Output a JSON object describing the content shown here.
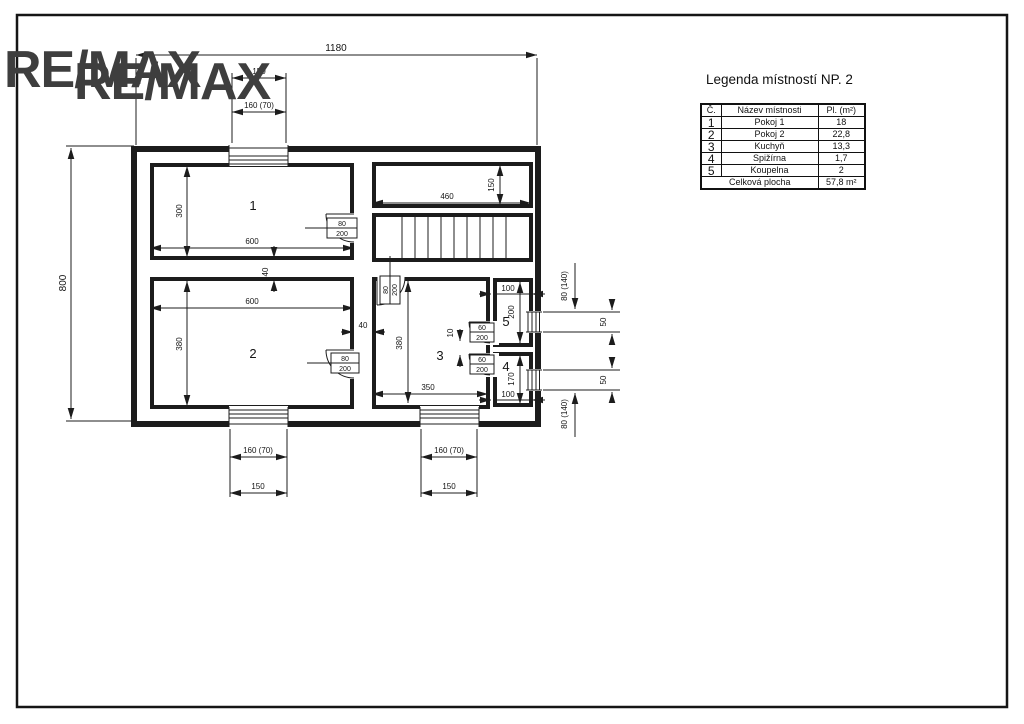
{
  "logo": {
    "text": "RE/MAX"
  },
  "legend": {
    "title": "Legenda místností NP. 2",
    "col_no": "Č.",
    "col_name": "Název místnosti",
    "col_area": "Pl. (m²)",
    "rows": [
      {
        "no": "1",
        "name": "Pokoj 1",
        "area": "18"
      },
      {
        "no": "2",
        "name": "Pokoj 2",
        "area": "22,8"
      },
      {
        "no": "3",
        "name": "Kuchyň",
        "area": "13,3"
      },
      {
        "no": "4",
        "name": "Spižírna",
        "area": "1,7"
      },
      {
        "no": "5",
        "name": "Koupelna",
        "area": "2"
      }
    ],
    "total_label": "Celková plocha",
    "total_value": "57,8 m²"
  },
  "plan": {
    "rooms": {
      "r1": "1",
      "r2": "2",
      "r3": "3",
      "r4": "4",
      "r5": "5"
    },
    "dims": {
      "overall_w": "1180",
      "overall_h": "800",
      "win_w": "160 (70)",
      "win_w_clear": "150",
      "r1_h": "300",
      "r1_w": "600",
      "wall": "40",
      "r2_w": "600",
      "r2_h": "380",
      "stair_w": "460",
      "stair_h": "150",
      "r3_h": "380",
      "r3_w": "350",
      "gap": "10",
      "r5_w": "100",
      "r5_h": "200",
      "r4_w": "100",
      "r4_h": "170",
      "side_win_h": "50",
      "side_win": "80 (140)"
    },
    "door_labels": {
      "w80": "80",
      "w60": "60",
      "h200": "200"
    }
  }
}
